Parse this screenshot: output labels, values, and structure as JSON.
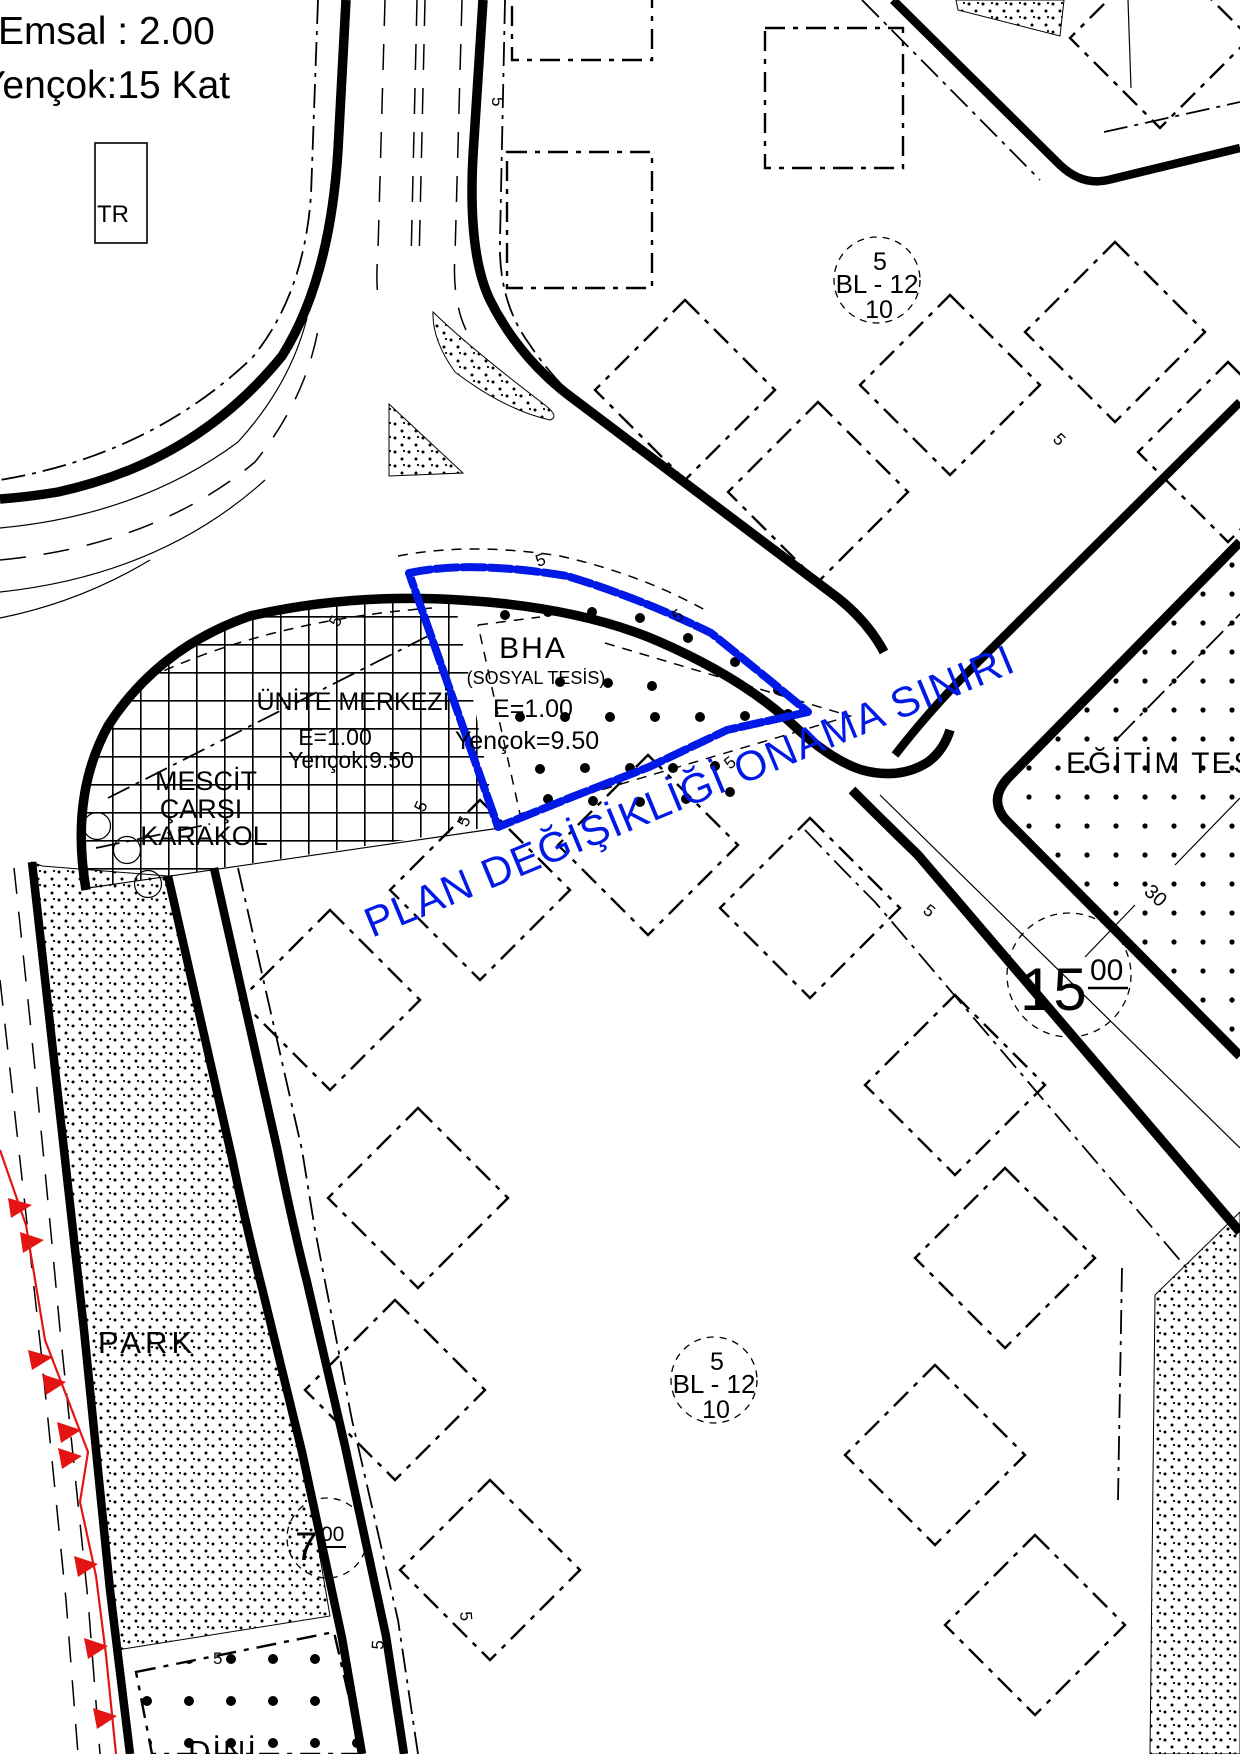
{
  "title_block": {
    "emsal": "Emsal : 2.00",
    "yencok": "Yençok:15 Kat"
  },
  "labels": {
    "tr": "TR",
    "park": "PARK",
    "dini": "DİNİ",
    "egitim_tesis": "EĞİTİM TES",
    "plan_boundary": "PLAN DEĞİŞİKLİĞİ ONAMA SINIRI"
  },
  "zones": {
    "bha": {
      "code": "BHA",
      "subtitle": "(SOSYAL TESİS)",
      "emsal": "E=1.00",
      "yencok": "Yençok=9.50"
    },
    "unite_merkezi": {
      "name": "ÜNİTE MERKEZİ",
      "emsal": "E=1.00",
      "yencok": "Yençok:9.50",
      "uses": [
        "MESCİT",
        "ÇARŞI",
        "KARAKOL"
      ]
    }
  },
  "blocks": {
    "bl12": {
      "top": "5",
      "code": "BL - 12",
      "bottom": "10"
    }
  },
  "road_widths": {
    "w15": {
      "value": "15",
      "decimal": "00"
    },
    "w7": {
      "value": "7",
      "decimal": "00"
    }
  },
  "dims": {
    "setback": "5",
    "depth": "30"
  },
  "colors": {
    "approval_boundary_blue": "#0019e6",
    "cadastre_red": "#e51414",
    "ink": "#000000"
  }
}
